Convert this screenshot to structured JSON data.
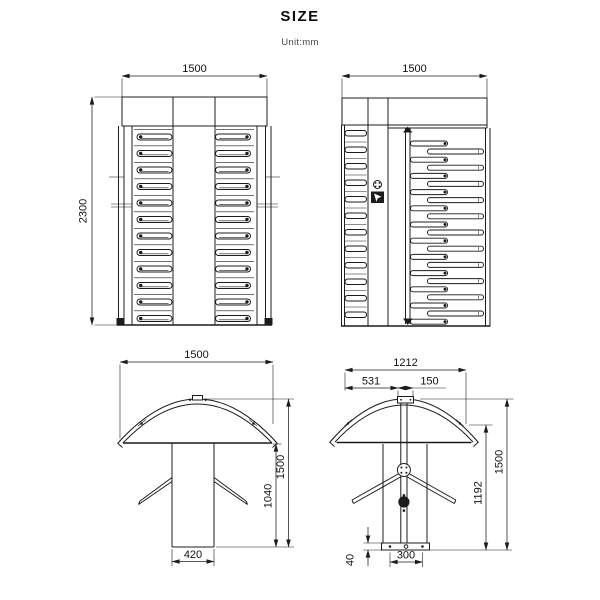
{
  "page": {
    "title": "SIZE",
    "unit": "Unit:mm"
  },
  "drawings": {
    "front_view": {
      "dim_width": "1500",
      "dim_height": "2300"
    },
    "side_view": {
      "dim_width": "1500"
    },
    "tripod_front_view": {
      "dim_width": "1500",
      "dim_column_width": "420",
      "dim_column_height": "1040",
      "dim_total_height": "1500"
    },
    "tripod_side_view": {
      "dim_width": "1212",
      "dim_offset_left": "531",
      "dim_cap_width": "150",
      "dim_hub_height": "1192",
      "dim_total_height": "1500",
      "dim_base_width": "300",
      "dim_base_height": "40"
    }
  }
}
